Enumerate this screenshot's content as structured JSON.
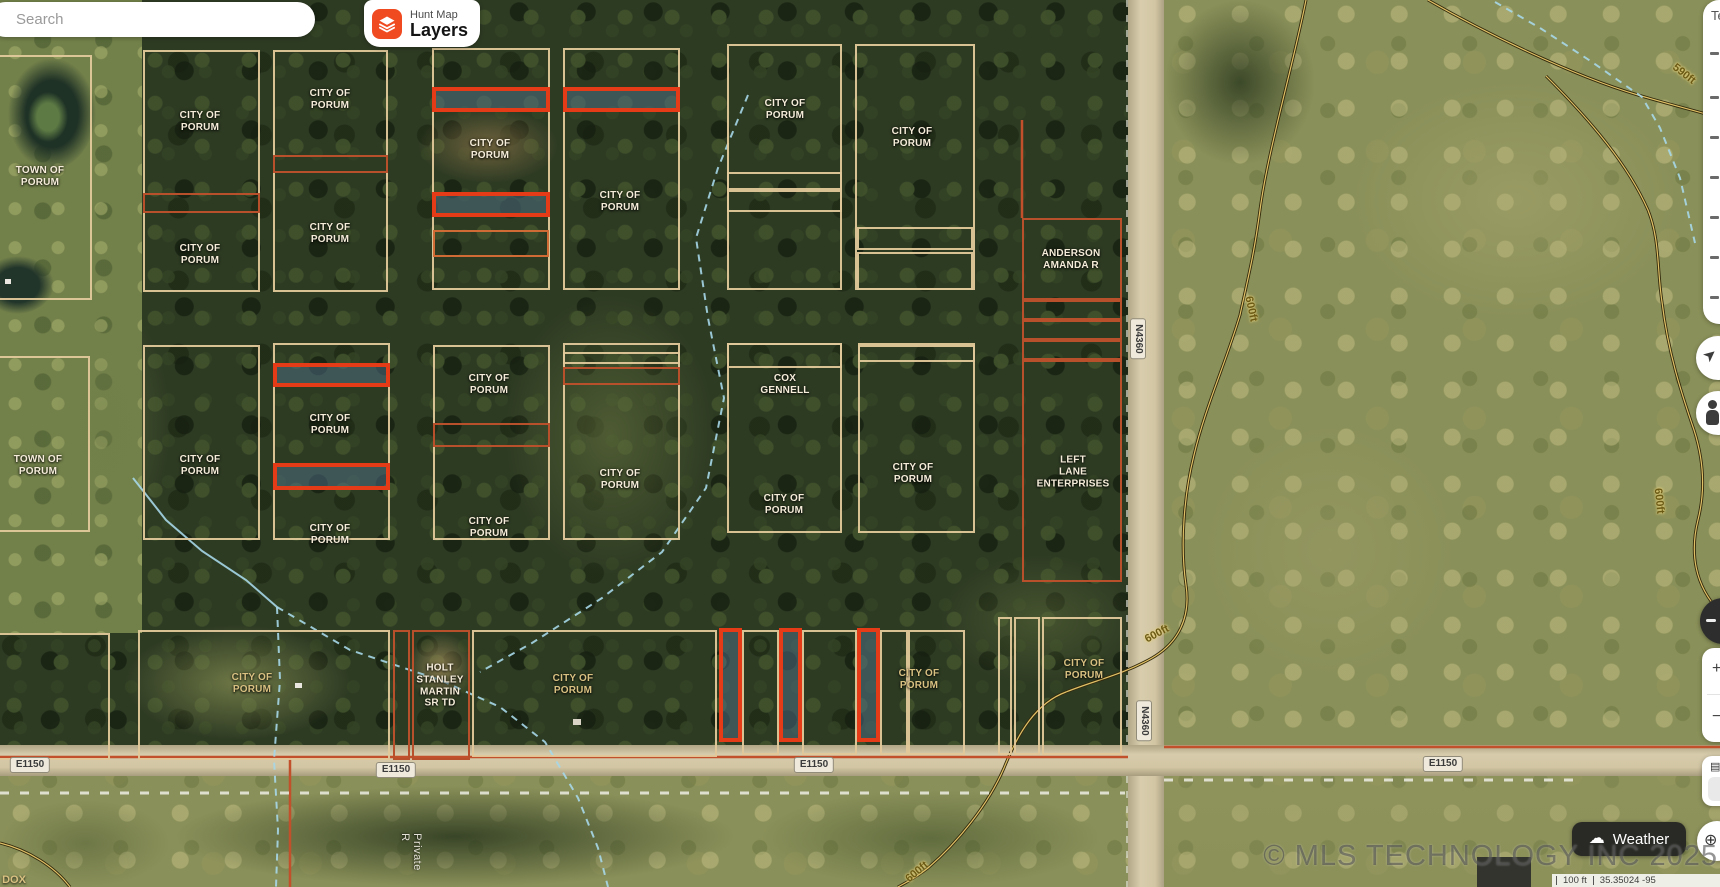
{
  "header": {
    "search": {
      "placeholder": "Search"
    },
    "layers_button": {
      "app_name": "Hunt Map",
      "label": "Layers"
    }
  },
  "controls": {
    "weather_label": "Weather",
    "panel_fragment": "Te",
    "zoom_in_glyph": "+",
    "zoom_out_glyph": "−",
    "cards_glyph": "▤",
    "globe_glyph": "⊕",
    "location_arrow_glyph": "➤"
  },
  "footer": {
    "copyright": "© MLS TECHNOLOGY INC 2025",
    "scale_distance": "100 ft",
    "coordinates": "35.35024 -95"
  },
  "colors": {
    "accent_orange": "#F04A21",
    "parcel_tan": "#E2C89A",
    "parcel_rust": "#B8502C",
    "parcel_red": "#E63B17",
    "road_fill": "#D2C6A4",
    "creek_blue": "#A6D7E8",
    "contour_dark": "#32290C",
    "contour_light": "#E0C167"
  },
  "map": {
    "parcel_labels": [
      {
        "text": "TOWN OF\nPORUM",
        "x": 40,
        "y": 177
      },
      {
        "text": "CITY OF\nPORUM",
        "x": 200,
        "y": 122
      },
      {
        "text": "CITY OF\nPORUM",
        "x": 200,
        "y": 255
      },
      {
        "text": "CITY OF\nPORUM",
        "x": 330,
        "y": 100
      },
      {
        "text": "CITY OF\nPORUM",
        "x": 330,
        "y": 234
      },
      {
        "text": "CITY OF\nPORUM",
        "x": 490,
        "y": 150
      },
      {
        "text": "CITY OF\nPORUM",
        "x": 620,
        "y": 202
      },
      {
        "text": "CITY OF\nPORUM",
        "x": 785,
        "y": 110
      },
      {
        "text": "CITY OF\nPORUM",
        "x": 912,
        "y": 138
      },
      {
        "text": "ANDERSON\nAMANDA R",
        "x": 1071,
        "y": 260
      },
      {
        "text": "TOWN OF\nPORUM",
        "x": 38,
        "y": 466
      },
      {
        "text": "CITY OF\nPORUM",
        "x": 200,
        "y": 466
      },
      {
        "text": "CITY OF\nPORUM",
        "x": 330,
        "y": 425
      },
      {
        "text": "CITY OF\nPORUM",
        "x": 330,
        "y": 535
      },
      {
        "text": "CITY OF\nPORUM",
        "x": 489,
        "y": 385
      },
      {
        "text": "CITY OF\nPORUM",
        "x": 489,
        "y": 528
      },
      {
        "text": "CITY OF\nPORUM",
        "x": 620,
        "y": 480
      },
      {
        "text": "COX\nGENNELL",
        "x": 785,
        "y": 385
      },
      {
        "text": "CITY OF\nPORUM",
        "x": 784,
        "y": 505
      },
      {
        "text": "CITY OF\nPORUM",
        "x": 913,
        "y": 474
      },
      {
        "text": "LEFT\nLANE\nENTERPRISES",
        "x": 1073,
        "y": 472
      },
      {
        "text": "CITY OF\nPORUM",
        "x": 252,
        "y": 684,
        "c": "khaki"
      },
      {
        "text": "HOLT\nSTANLEY\nMARTIN\nSR TD",
        "x": 440,
        "y": 686
      },
      {
        "text": "CITY OF\nPORUM",
        "x": 573,
        "y": 685,
        "c": "khaki"
      },
      {
        "text": "CITY OF\nPORUM",
        "x": 919,
        "y": 680,
        "c": "khaki"
      },
      {
        "text": "CITY OF\nPORUM",
        "x": 1084,
        "y": 670,
        "c": "khaki"
      }
    ],
    "road_labels": [
      {
        "text": "E1150",
        "x": 30,
        "y": 765
      },
      {
        "text": "E1150",
        "x": 396,
        "y": 770
      },
      {
        "text": "E1150",
        "x": 814,
        "y": 765
      },
      {
        "text": "E1150",
        "x": 1443,
        "y": 764
      },
      {
        "text": "N4360",
        "x": 1138,
        "y": 339,
        "vertical": true
      },
      {
        "text": "N4360",
        "x": 1144,
        "y": 721,
        "vertical": true
      }
    ],
    "contour_labels": [
      {
        "text": "590ft",
        "x": 1684,
        "y": 74,
        "rot": 38
      },
      {
        "text": "600ft",
        "x": 1251,
        "y": 309,
        "rot": 78
      },
      {
        "text": "600ft",
        "x": 1157,
        "y": 634,
        "rot": -28
      },
      {
        "text": "600ft",
        "x": 1659,
        "y": 501,
        "rot": 84
      },
      {
        "text": "600ft",
        "x": 917,
        "y": 872,
        "rot": -40
      }
    ],
    "misc_labels": [
      {
        "text": "Private R",
        "x": 411,
        "y": 852,
        "vertical": true,
        "c": "road-side"
      },
      {
        "text": "DOX",
        "x": 14,
        "y": 880,
        "c": "khaki"
      }
    ],
    "parcels": [
      {
        "x": -30,
        "y": 55,
        "w": 122,
        "h": 245,
        "t": "tan"
      },
      {
        "x": 143,
        "y": 50,
        "w": 117,
        "h": 242,
        "t": "tan"
      },
      {
        "x": 143,
        "y": 193,
        "w": 117,
        "h": 20,
        "t": "rust"
      },
      {
        "x": 273,
        "y": 50,
        "w": 115,
        "h": 242,
        "t": "tan"
      },
      {
        "x": 273,
        "y": 155,
        "w": 115,
        "h": 18,
        "t": "rust"
      },
      {
        "x": 432,
        "y": 48,
        "w": 118,
        "h": 242,
        "t": "tan"
      },
      {
        "x": 432,
        "y": 87,
        "w": 118,
        "h": 25,
        "t": "red"
      },
      {
        "x": 432,
        "y": 192,
        "w": 118,
        "h": 25,
        "t": "red"
      },
      {
        "x": 433,
        "y": 230,
        "w": 116,
        "h": 27,
        "t": "orange"
      },
      {
        "x": 563,
        "y": 48,
        "w": 117,
        "h": 242,
        "t": "tan"
      },
      {
        "x": 563,
        "y": 87,
        "w": 117,
        "h": 25,
        "t": "red"
      },
      {
        "x": 727,
        "y": 44,
        "w": 115,
        "h": 246,
        "t": "tan"
      },
      {
        "x": 727,
        "y": 172,
        "w": 115,
        "h": 18,
        "t": "tan"
      },
      {
        "x": 727,
        "y": 190,
        "w": 115,
        "h": 22,
        "t": "tan"
      },
      {
        "x": 855,
        "y": 44,
        "w": 120,
        "h": 246,
        "t": "tan"
      },
      {
        "x": 857,
        "y": 227,
        "w": 116,
        "h": 23,
        "t": "tan"
      },
      {
        "x": 857,
        "y": 252,
        "w": 116,
        "h": 38,
        "t": "tan"
      },
      {
        "x": 1022,
        "y": 218,
        "w": 100,
        "h": 82,
        "t": "rust"
      },
      {
        "x": 1022,
        "y": 300,
        "w": 100,
        "h": 20,
        "t": "rust"
      },
      {
        "x": 1022,
        "y": 320,
        "w": 100,
        "h": 20,
        "t": "rust"
      },
      {
        "x": 1022,
        "y": 340,
        "w": 100,
        "h": 20,
        "t": "rust"
      },
      {
        "x": 1022,
        "y": 360,
        "w": 100,
        "h": 222,
        "t": "rust"
      },
      {
        "x": -30,
        "y": 356,
        "w": 120,
        "h": 176,
        "t": "tan"
      },
      {
        "x": 143,
        "y": 345,
        "w": 117,
        "h": 195,
        "t": "tan"
      },
      {
        "x": 273,
        "y": 343,
        "w": 117,
        "h": 197,
        "t": "tan"
      },
      {
        "x": 273,
        "y": 363,
        "w": 117,
        "h": 24,
        "t": "red"
      },
      {
        "x": 273,
        "y": 463,
        "w": 117,
        "h": 27,
        "t": "red"
      },
      {
        "x": 433,
        "y": 345,
        "w": 117,
        "h": 195,
        "t": "tan"
      },
      {
        "x": 433,
        "y": 423,
        "w": 117,
        "h": 24,
        "t": "rust"
      },
      {
        "x": 563,
        "y": 343,
        "w": 117,
        "h": 197,
        "t": "tan"
      },
      {
        "x": 563,
        "y": 352,
        "w": 117,
        "h": 12,
        "t": "tan"
      },
      {
        "x": 563,
        "y": 367,
        "w": 117,
        "h": 18,
        "t": "rust"
      },
      {
        "x": 727,
        "y": 343,
        "w": 115,
        "h": 190,
        "t": "tan"
      },
      {
        "x": 727,
        "y": 343,
        "w": 115,
        "h": 25,
        "t": "tan"
      },
      {
        "x": 858,
        "y": 343,
        "w": 117,
        "h": 190,
        "t": "tan"
      },
      {
        "x": 858,
        "y": 345,
        "w": 117,
        "h": 17,
        "t": "tan"
      },
      {
        "x": -30,
        "y": 633,
        "w": 140,
        "h": 127,
        "t": "tan"
      },
      {
        "x": 138,
        "y": 630,
        "w": 252,
        "h": 130,
        "t": "tan"
      },
      {
        "x": 393,
        "y": 630,
        "w": 17,
        "h": 130,
        "t": "rust"
      },
      {
        "x": 412,
        "y": 630,
        "w": 58,
        "h": 130,
        "t": "rust"
      },
      {
        "x": 472,
        "y": 630,
        "w": 245,
        "h": 127,
        "t": "tan"
      },
      {
        "x": 719,
        "y": 628,
        "w": 23,
        "h": 114,
        "t": "red"
      },
      {
        "x": 742,
        "y": 630,
        "w": 37,
        "h": 125,
        "t": "tan"
      },
      {
        "x": 779,
        "y": 628,
        "w": 23,
        "h": 114,
        "t": "red"
      },
      {
        "x": 802,
        "y": 630,
        "w": 55,
        "h": 125,
        "t": "tan"
      },
      {
        "x": 857,
        "y": 628,
        "w": 23,
        "h": 114,
        "t": "red"
      },
      {
        "x": 880,
        "y": 630,
        "w": 28,
        "h": 125,
        "t": "tan"
      },
      {
        "x": 908,
        "y": 630,
        "w": 57,
        "h": 125,
        "t": "tan"
      },
      {
        "x": 998,
        "y": 617,
        "w": 14,
        "h": 138,
        "t": "tan"
      },
      {
        "x": 1014,
        "y": 617,
        "w": 26,
        "h": 138,
        "t": "tan"
      },
      {
        "x": 1042,
        "y": 617,
        "w": 80,
        "h": 138,
        "t": "tan"
      }
    ],
    "contour_paths": [
      "M1428,0 C1480,30 1570,75 1638,95 C1672,105 1700,112 1720,118",
      "M1306,0 C1292,70 1268,150 1260,210 C1254,255 1248,278 1240,315 C1226,362 1205,408 1194,455 C1184,495 1180,545 1186,585 C1191,618 1178,643 1152,658 C1122,675 1096,680 1066,692 C1036,703 1018,733 1004,768 C988,805 958,842 928,868 C914,879 905,883 898,887",
      "M1546,76 C1592,122 1628,165 1648,210 C1660,240 1657,270 1662,302 C1668,352 1681,392 1694,430 C1703,458 1706,488 1698,520 C1690,552 1694,585 1720,612",
      "M0,843 C28,850 54,866 70,887"
    ],
    "creeks": [
      {
        "pts": "1495,2 1540,28 1592,62 1642,97 1660,128 1680,178 1695,243",
        "dash": true
      },
      {
        "pts": "748,95 718,168 696,238 708,318 724,398 706,488 662,552 602,598 532,643 480,672",
        "dash": true
      },
      {
        "pts": "133,478 166,520 202,551 246,580 277,607",
        "dash": false
      },
      {
        "pts": "277,607 280,680 274,760 278,830 276,887",
        "dash": true
      },
      {
        "pts": "277,607 350,650 440,680 500,707 545,742 578,798 598,848 608,887",
        "dash": true
      }
    ],
    "cadastral_lines": [
      "M0,757 L1128,757",
      "M290,757 L290,887",
      "M1164,747 L1720,747",
      "M1022,120 L1022,218"
    ],
    "section_lines": [
      {
        "d": "M0,793 L1125,793"
      },
      {
        "d": "M1164,780 L1575,780"
      },
      {
        "d": "M1127,0 L1127,745",
        "v": true
      },
      {
        "d": "M1127,776 L1127,887",
        "v": true
      }
    ]
  }
}
